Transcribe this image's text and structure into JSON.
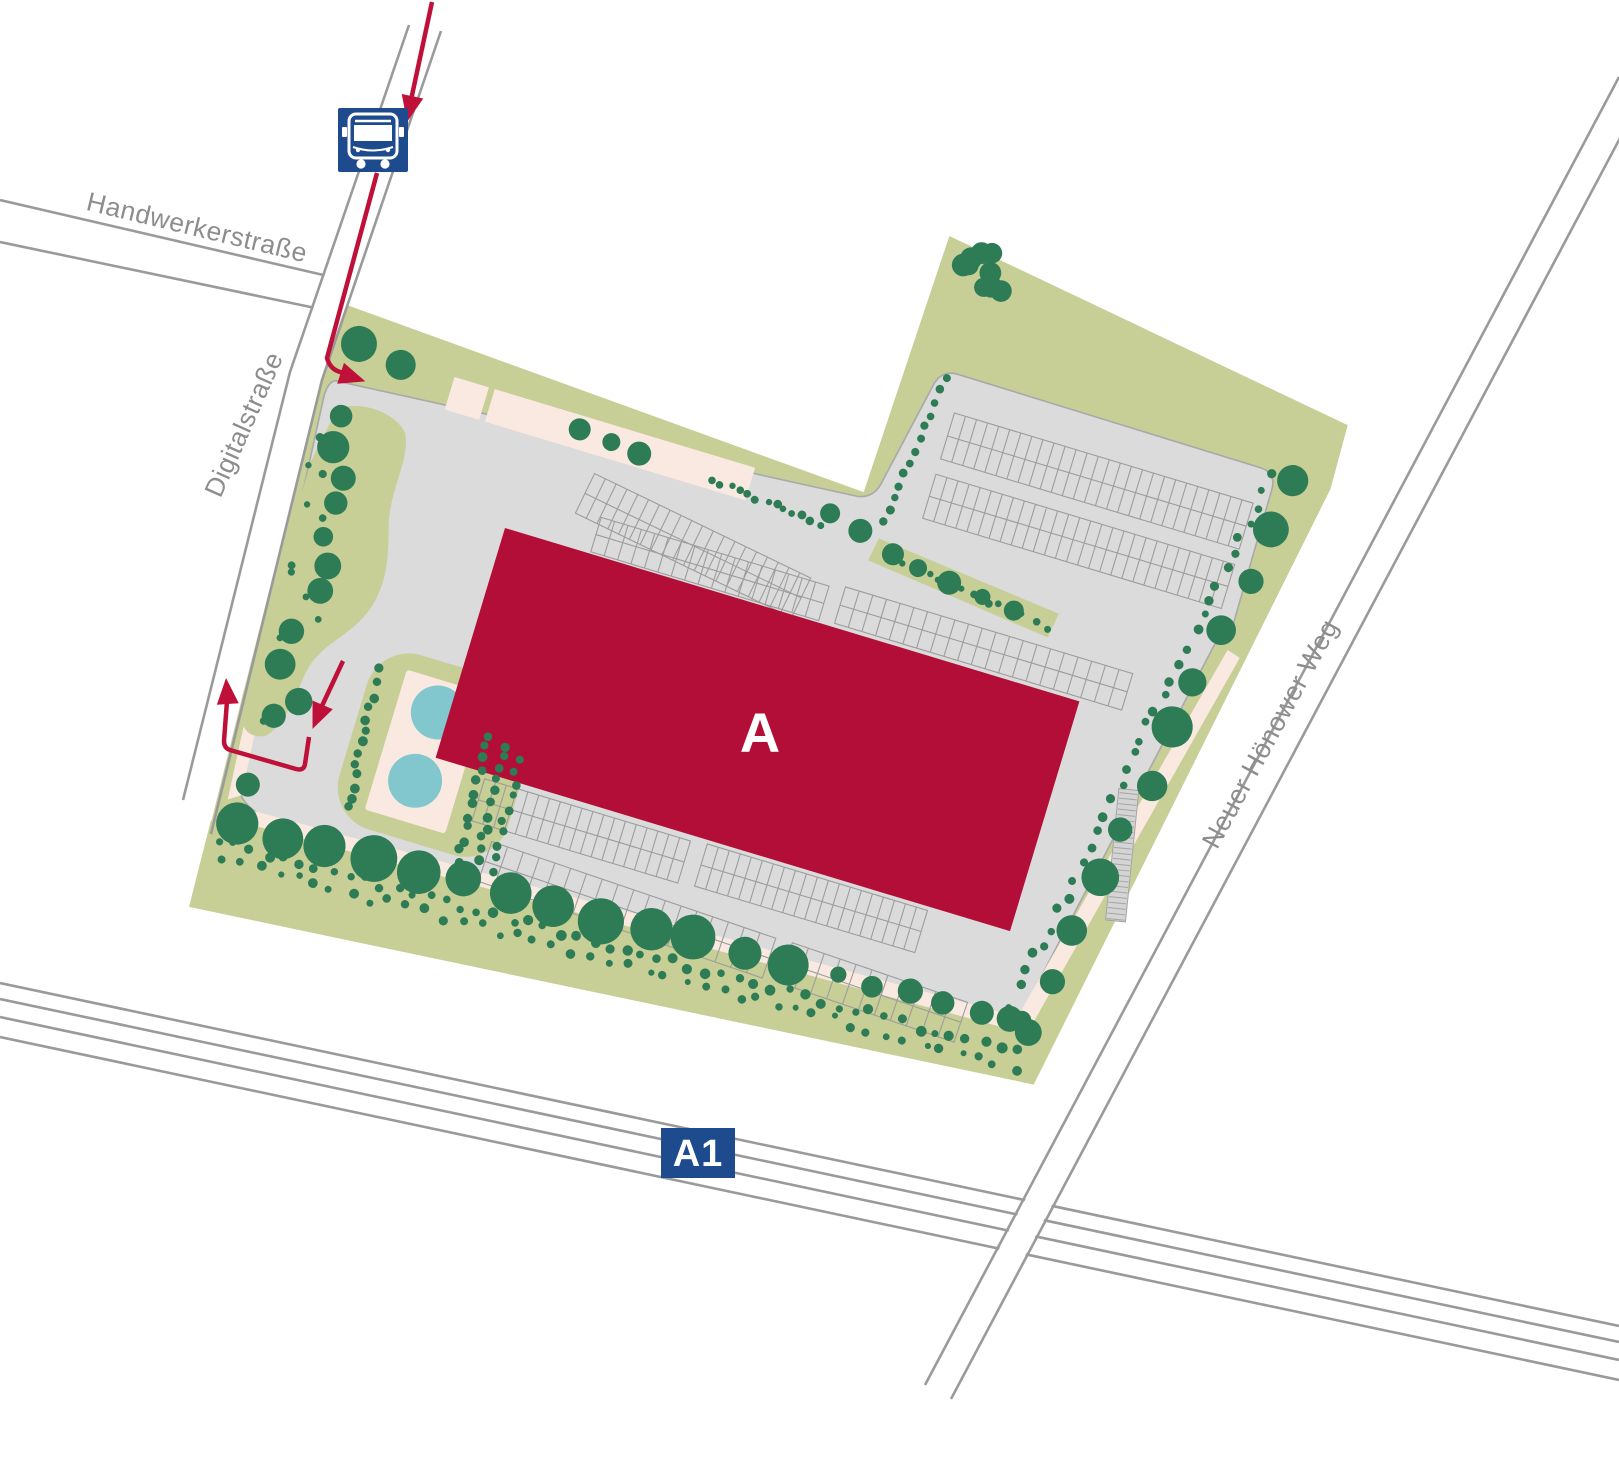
{
  "map_title": "Site plan with building A",
  "streets": {
    "handwerkerstrasse": {
      "label": "Handwerkerstraße"
    },
    "digitalstrasse": {
      "label": "Digitalstraße"
    },
    "neuer_hoenower_weg": {
      "label": "Neuer Hönower Weg"
    }
  },
  "highway": {
    "badge": "A1"
  },
  "building": {
    "label": "A"
  },
  "bus_stop": {
    "icon": "bus-icon"
  },
  "route": {
    "icons": [
      "arrow-down-icon",
      "arrow-into-site-icon",
      "arrow-exit-up-icon",
      "arrow-entry-down-icon"
    ]
  },
  "colors": {
    "site_green": "#C7CE96",
    "tree_green": "#2E7C55",
    "pavement": "#DBDBDB",
    "building_red": "#B30E37",
    "route_red": "#BE1038",
    "pond_teal": "#82C7CE",
    "sidewalk_cream": "#FAE9E1",
    "road_gray": "#9A9A9A",
    "sign_navy": "#1E4A8E",
    "label_gray": "#8D8D8D"
  }
}
